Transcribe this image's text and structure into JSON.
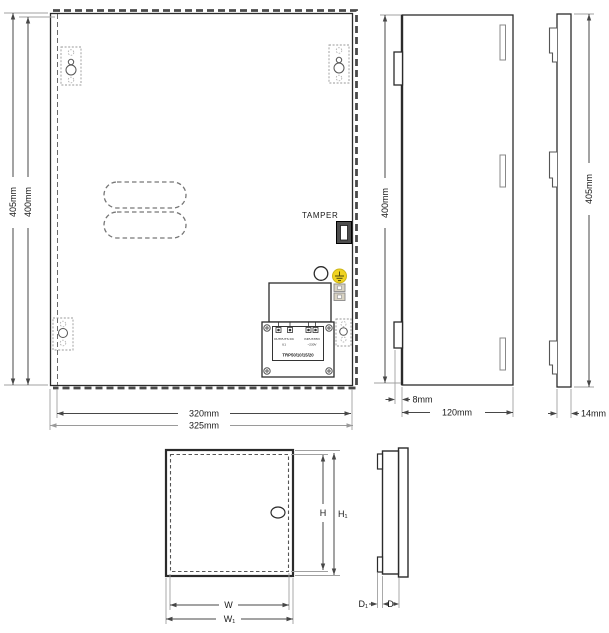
{
  "drawing": {
    "front_view": {
      "tamper_label": "TAMPER",
      "dim_height_outer": "405mm",
      "dim_height_inner": "400mm",
      "dim_width_inner": "320mm",
      "dim_width_outer": "325mm",
      "pcb": {
        "output_label": "OUTPUTS DC",
        "output_ref": "U1",
        "input_label": "INPUT/PRI",
        "input_voltage": "~230V",
        "model": "TRP50/10/15/20"
      }
    },
    "side_view": {
      "dim_height": "400mm",
      "dim_door_offset": "8mm",
      "dim_depth": "120mm"
    },
    "door_view": {
      "dim_height": "405mm",
      "dim_thickness": "14mm"
    },
    "key_front_view": {
      "dim_height_inner": "H",
      "dim_height_outer": "H₁",
      "dim_width_inner": "W",
      "dim_width_outer": "W₁"
    },
    "key_side_view": {
      "dim_offset": "D₁",
      "dim_depth": "D"
    },
    "colors": {
      "line": "#2b2b2b",
      "dim_line": "#474747",
      "light_line": "#9a9a9a",
      "earth_yellow": "#f0d321",
      "terminal_fill": "#d9d3c2",
      "switch_fill": "#4d4d4d"
    }
  }
}
